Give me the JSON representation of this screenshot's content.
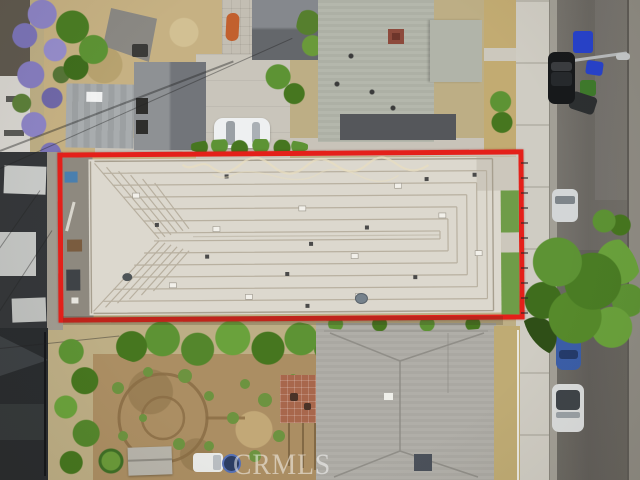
{
  "scene": {
    "type": "aerial-photo",
    "watermark": "CRMLS",
    "colors": {
      "outline_red": "#e4201a",
      "roof_light": "#dcd8ce",
      "roof_seam": "#b8b0a0",
      "street_asphalt": "#6e6b66",
      "sidewalk_concrete": "#cfccc3",
      "grass_green": "#6f9c48",
      "dry_grass": "#c6b183",
      "tree_green": "#5d9334",
      "jacaranda_purple": "#8d84c6",
      "garden_soil": "#ab8e63",
      "house_roof_gray": "#b4b7ac",
      "dark_building": "#34373a"
    }
  }
}
